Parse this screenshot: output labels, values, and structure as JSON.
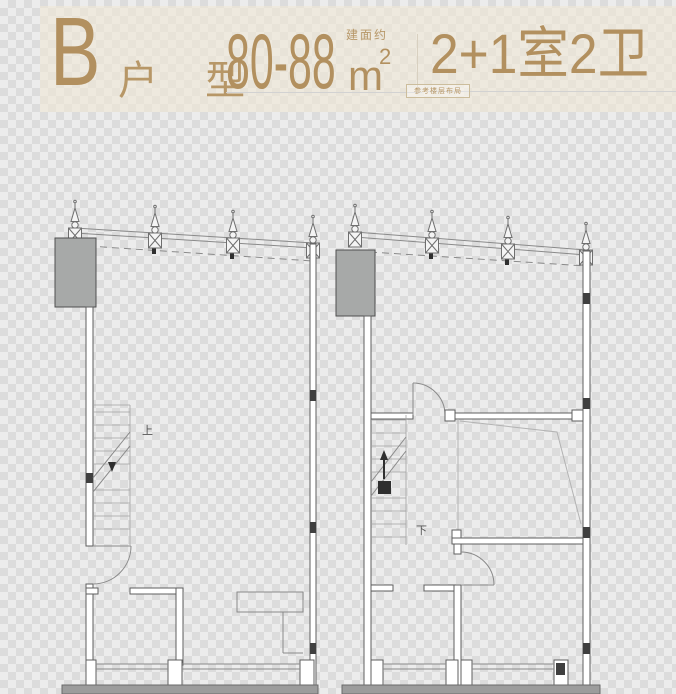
{
  "header": {
    "unit_type_letter": "B",
    "unit_type_label": "户 型",
    "area_value": "80-88",
    "area_unit": "m",
    "area_superscript": "2",
    "area_prefix_note": "建面约",
    "rooms_value": "2+1室2卫",
    "rooms_note": "参考楼层布局"
  },
  "floorplan": {
    "stair_up_label": "上",
    "stair_down_label": "下"
  },
  "colors": {
    "accent": "#b2905f",
    "accent-light": "#b79767",
    "checker-light": "#ececec",
    "checker-dark": "#dcdcdc",
    "header-tint": "rgba(240,232,214,0.60)",
    "plan-line": "#8a8a8a",
    "plan-wall": "#5f5f5f",
    "plan-dark": "#3f3f3f",
    "slab-gray": "#a7a9a8",
    "strip-gray": "#9c9c9c",
    "divider": "#d8d0c0"
  }
}
